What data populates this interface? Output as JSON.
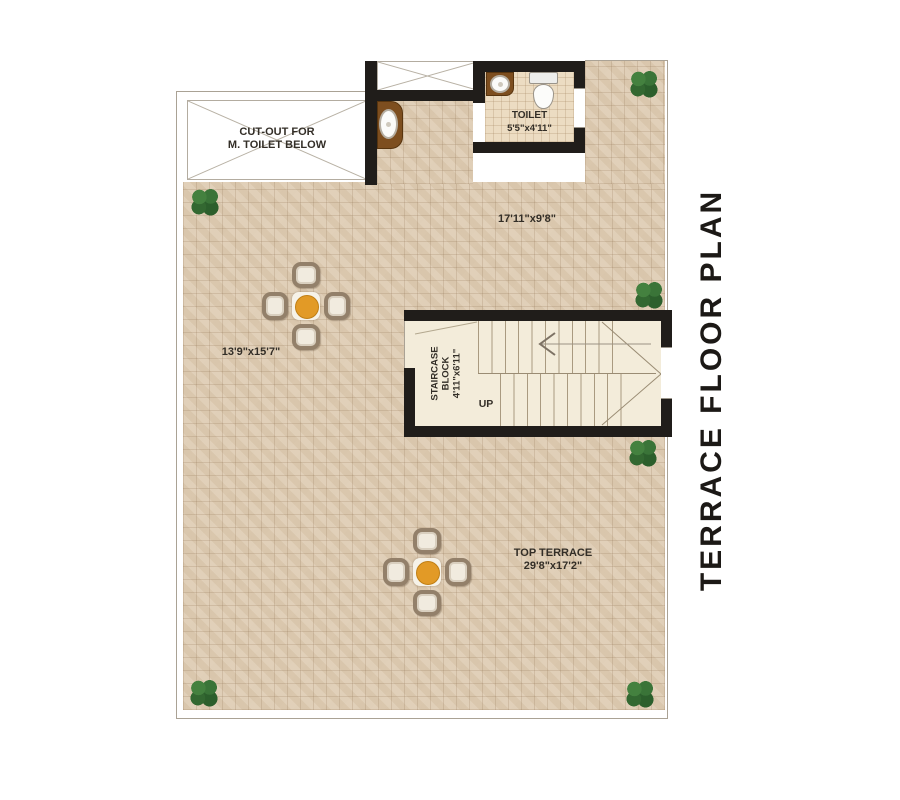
{
  "side_title": "TERRACE FLOOR PLAN",
  "labels": {
    "cutout_line1": "CUT-OUT FOR",
    "cutout_line2": "M. TOILET BELOW",
    "toilet_name": "TOILET",
    "toilet_dim": "5'5\"x4'11\"",
    "upper_terrace_dim": "17'11\"x9'8\"",
    "left_terrace_dim": "13'9\"x15'7\"",
    "staircase_line1": "STAIRCASE",
    "staircase_line2": "BLOCK",
    "staircase_dim": "4'11\"x6'11\"",
    "up_label": "UP",
    "top_terrace_name": "TOP TERRACE",
    "top_terrace_dim": "29'8\"x17'2\""
  },
  "colors": {
    "wall": "#201d1a",
    "terrace_tile": "#dccab4",
    "toilet_floor": "#ecdcc2",
    "stair_floor": "#f3ecda",
    "counter_brown": "#7d4e1f",
    "table_orange": "#e29a26",
    "plant_green": "#2e632f",
    "text": "#332e27",
    "title_text": "#1c1916"
  }
}
